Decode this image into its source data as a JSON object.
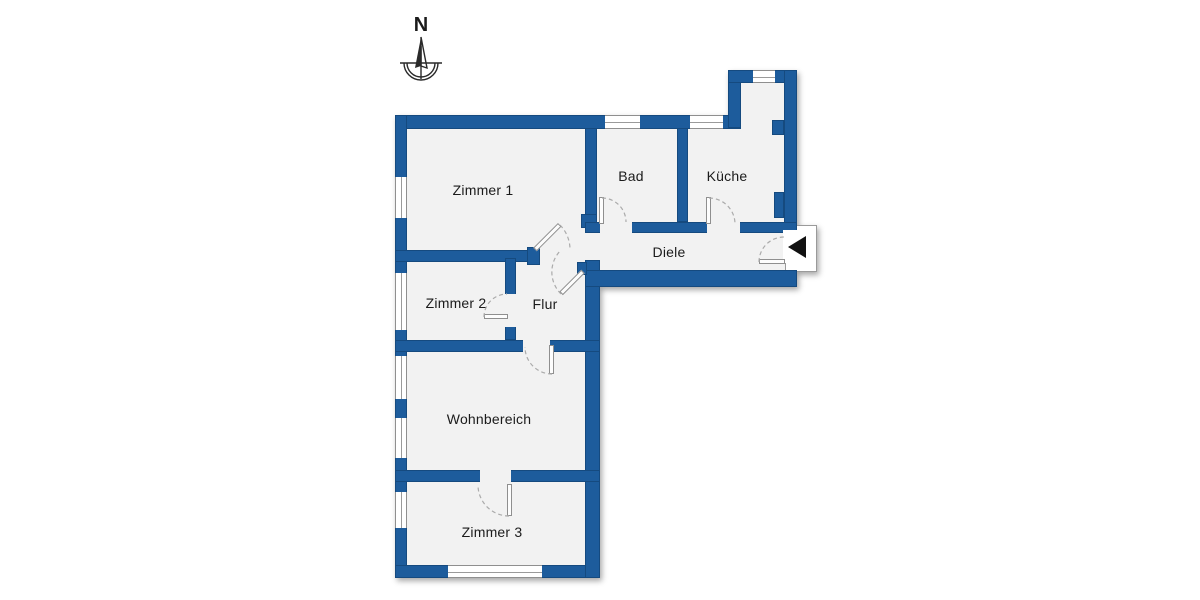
{
  "north": {
    "label": "N"
  },
  "colors": {
    "wall": "#1d5c9c",
    "wall_edge": "#11406f",
    "floor": "#f2f2f2",
    "background": "#ffffff",
    "window_line": "#8f8f8f",
    "door_arc": "#ababab",
    "label_text": "#1b1b1b",
    "entrance_arrow": "#111111"
  },
  "rooms": [
    {
      "id": "zimmer-1",
      "label": "Zimmer 1",
      "cx": 483,
      "cy": 190
    },
    {
      "id": "bad",
      "label": "Bad",
      "cx": 631,
      "cy": 176
    },
    {
      "id": "kueche",
      "label": "Küche",
      "cx": 727,
      "cy": 176
    },
    {
      "id": "diele",
      "label": "Diele",
      "cx": 669,
      "cy": 252
    },
    {
      "id": "zimmer-2",
      "label": "Zimmer 2",
      "cx": 456,
      "cy": 303
    },
    {
      "id": "flur",
      "label": "Flur",
      "cx": 545,
      "cy": 304
    },
    {
      "id": "wohnbereich",
      "label": "Wohnbereich",
      "cx": 489,
      "cy": 419
    },
    {
      "id": "zimmer-3",
      "label": "Zimmer 3",
      "cx": 492,
      "cy": 532
    }
  ],
  "plan": {
    "floors": [
      {
        "x": 401,
        "y": 121,
        "w": 390,
        "h": 160
      },
      {
        "x": 734,
        "y": 76,
        "w": 57,
        "h": 60
      },
      {
        "x": 401,
        "y": 121,
        "w": 193,
        "h": 451
      }
    ],
    "walls": [
      {
        "x": 395,
        "y": 115,
        "w": 346,
        "h": 14
      },
      {
        "x": 728,
        "y": 70,
        "w": 13,
        "h": 58
      },
      {
        "x": 728,
        "y": 70,
        "w": 69,
        "h": 13
      },
      {
        "x": 784,
        "y": 70,
        "w": 13,
        "h": 162
      },
      {
        "x": 772,
        "y": 120,
        "w": 12,
        "h": 15
      },
      {
        "x": 774,
        "y": 192,
        "w": 10,
        "h": 26
      },
      {
        "x": 395,
        "y": 115,
        "w": 12,
        "h": 463
      },
      {
        "x": 395,
        "y": 565,
        "w": 205,
        "h": 13
      },
      {
        "x": 585,
        "y": 260,
        "w": 15,
        "h": 318
      },
      {
        "x": 585,
        "y": 270,
        "w": 212,
        "h": 17
      },
      {
        "x": 585,
        "y": 128,
        "w": 12,
        "h": 88
      },
      {
        "x": 581,
        "y": 214,
        "w": 16,
        "h": 14
      },
      {
        "x": 677,
        "y": 128,
        "w": 11,
        "h": 94
      },
      {
        "x": 585,
        "y": 222,
        "w": 212,
        "h": 11
      },
      {
        "x": 395,
        "y": 250,
        "w": 140,
        "h": 12
      },
      {
        "x": 527,
        "y": 247,
        "w": 13,
        "h": 18
      },
      {
        "x": 505,
        "y": 258,
        "w": 11,
        "h": 82
      },
      {
        "x": 395,
        "y": 340,
        "w": 205,
        "h": 12
      },
      {
        "x": 395,
        "y": 470,
        "w": 205,
        "h": 12
      },
      {
        "x": 577,
        "y": 262,
        "w": 10,
        "h": 13
      }
    ],
    "cuts": [
      {
        "x": 600,
        "y": 221,
        "w": 32,
        "h": 13,
        "fill": "floor"
      },
      {
        "x": 707,
        "y": 221,
        "w": 33,
        "h": 13,
        "fill": "floor"
      },
      {
        "x": 505,
        "y": 294,
        "w": 11,
        "h": 33,
        "fill": "floor"
      },
      {
        "x": 523,
        "y": 339,
        "w": 27,
        "h": 14,
        "fill": "floor"
      },
      {
        "x": 480,
        "y": 469,
        "w": 31,
        "h": 14,
        "fill": "floor"
      },
      {
        "x": 783,
        "y": 230,
        "w": 15,
        "h": 33,
        "fill": "background"
      }
    ],
    "windows": [
      {
        "o": "v",
        "x": 395,
        "y": 177,
        "w": 12,
        "h": 41
      },
      {
        "o": "v",
        "x": 395,
        "y": 273,
        "w": 12,
        "h": 57
      },
      {
        "o": "v",
        "x": 395,
        "y": 356,
        "w": 12,
        "h": 43
      },
      {
        "o": "v",
        "x": 395,
        "y": 418,
        "w": 12,
        "h": 40
      },
      {
        "o": "v",
        "x": 395,
        "y": 492,
        "w": 12,
        "h": 36
      },
      {
        "o": "h",
        "x": 448,
        "y": 565,
        "w": 94,
        "h": 13
      },
      {
        "o": "h",
        "x": 605,
        "y": 115,
        "w": 35,
        "h": 14
      },
      {
        "o": "h",
        "x": 690,
        "y": 115,
        "w": 33,
        "h": 14
      },
      {
        "o": "h",
        "x": 753,
        "y": 70,
        "w": 22,
        "h": 13
      }
    ],
    "door_leaves": [
      {
        "x": 599,
        "y": 197,
        "w": 5,
        "h": 27,
        "r": 0
      },
      {
        "x": 706,
        "y": 197,
        "w": 5,
        "h": 27,
        "r": 0
      },
      {
        "x": 484,
        "y": 314,
        "w": 24,
        "h": 5,
        "r": 0
      },
      {
        "x": 549,
        "y": 345,
        "w": 5,
        "h": 29,
        "r": 0
      },
      {
        "x": 507,
        "y": 484,
        "w": 5,
        "h": 32,
        "r": 0
      },
      {
        "x": 759,
        "y": 259,
        "w": 26,
        "h": 5,
        "r": 0
      },
      {
        "x": 535,
        "y": 247,
        "w": 35,
        "h": 5,
        "r": -45
      },
      {
        "x": 583,
        "y": 269,
        "w": 31,
        "h": 5,
        "r": 135
      }
    ],
    "door_arcs": [
      "M602,198 A24,24 0 0 1 626,222",
      "M709,198 A26,26 0 0 1 735,224",
      "M484,317 A23,23 0 0 1 507,294",
      "M552,374 A27,27 0 0 1 525,347",
      "M509,516 A31,31 0 0 1 478,485",
      "M560,225 A35,35 0 0 1 570,250",
      "M561,294 A31,31 0 0 1 561,250",
      "M759,262 A25,25 0 0 1 784,237"
    ],
    "entrance": {
      "box": {
        "x": 785,
        "y": 225,
        "w": 32,
        "h": 47
      },
      "triangle": "788,247 806,236 806,258"
    }
  }
}
